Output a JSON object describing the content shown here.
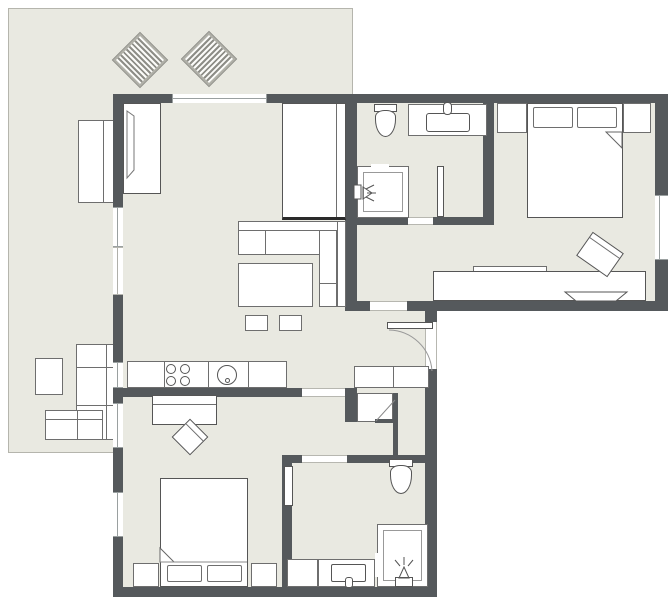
{
  "title": "apartment-floor-plan",
  "colors": {
    "wall": "#55595c",
    "floor": "#e9e9e1",
    "furn": "#ffffff",
    "line": "#6e6e6e",
    "terrace-border": "#b5b5ad",
    "bg": "#ffffff",
    "win": "#9aa0a0"
  },
  "rooms": [
    {
      "name": "terrace",
      "furniture": [
        "lounge-chair",
        "lounge-chair",
        "outdoor-bench",
        "outdoor-side-table",
        "outdoor-corner-sofa"
      ]
    },
    {
      "name": "living-room",
      "furniture": [
        "wardrobe-open-door",
        "wardrobe",
        "corner-sofa",
        "coffee-table",
        "stool",
        "stool"
      ]
    },
    {
      "name": "kitchen",
      "furniture": [
        "counter",
        "stove-4-burners",
        "sink-round"
      ]
    },
    {
      "name": "bathroom-top",
      "furniture": [
        "toilet",
        "vanity-sink",
        "shower-cabin"
      ]
    },
    {
      "name": "bedroom-right",
      "furniture": [
        "double-bed",
        "pillow",
        "pillow",
        "nightstand",
        "nightstand",
        "desk",
        "desk-chair",
        "lounge-chair"
      ]
    },
    {
      "name": "hallway",
      "furniture": [
        "cabinet",
        "closet",
        "entry-door"
      ]
    },
    {
      "name": "bedroom-left",
      "furniture": [
        "desk",
        "chair",
        "double-bed",
        "pillow",
        "pillow",
        "nightstand",
        "nightstand"
      ]
    },
    {
      "name": "bathroom-bottom",
      "furniture": [
        "toilet",
        "vanity-sink",
        "shower-cabin"
      ]
    }
  ],
  "openings": [
    "window",
    "window",
    "window",
    "window",
    "window",
    "window",
    "window",
    "sliding-terrace-door",
    "entry-door",
    "interior-doorways"
  ]
}
